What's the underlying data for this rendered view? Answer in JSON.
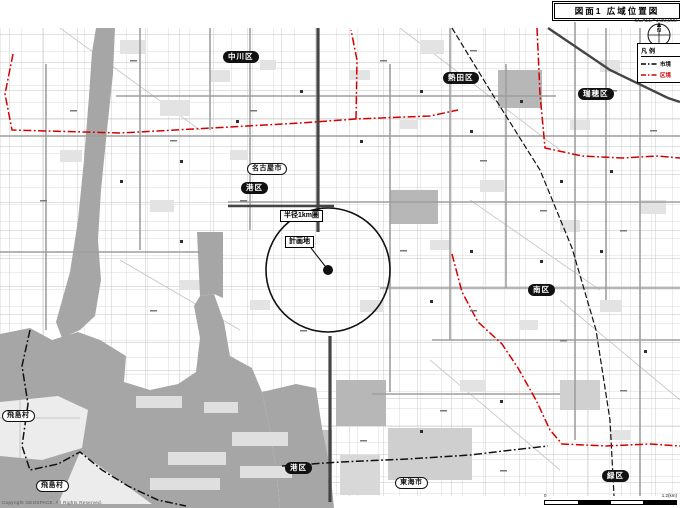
{
  "header": {
    "title": "図面1 広域位置図",
    "scale_note": "SCALE=1:30,000"
  },
  "compass": {
    "north": "N"
  },
  "legend": {
    "title": "凡例",
    "items": [
      {
        "label": "市境",
        "color": "#000000",
        "text_color": "#000000",
        "style": "dash-dot"
      },
      {
        "label": "区境",
        "color": "#d40000",
        "text_color": "#d40000",
        "style": "dash-dot"
      }
    ]
  },
  "labels": {
    "nakagawa_ward": "中川区",
    "atsuta_ward": "熱田区",
    "mizuho_ward": "瑞穂区",
    "minato_ward": "港区",
    "minami_ward": "南区",
    "minato_ward2": "港区",
    "midori_ward": "緑区",
    "nagoya_city": "名古屋市",
    "tobishima_village1": "飛島村",
    "tobishima_village2": "飛島村",
    "tokai_city": "東海市",
    "radius_ring": "半径1km圏",
    "plan_site": "計画地"
  },
  "scalebar": {
    "zero": "0",
    "label": "1.2(km)"
  },
  "copyright": "Copyright GEOSPACE. All Rights Reserved."
}
